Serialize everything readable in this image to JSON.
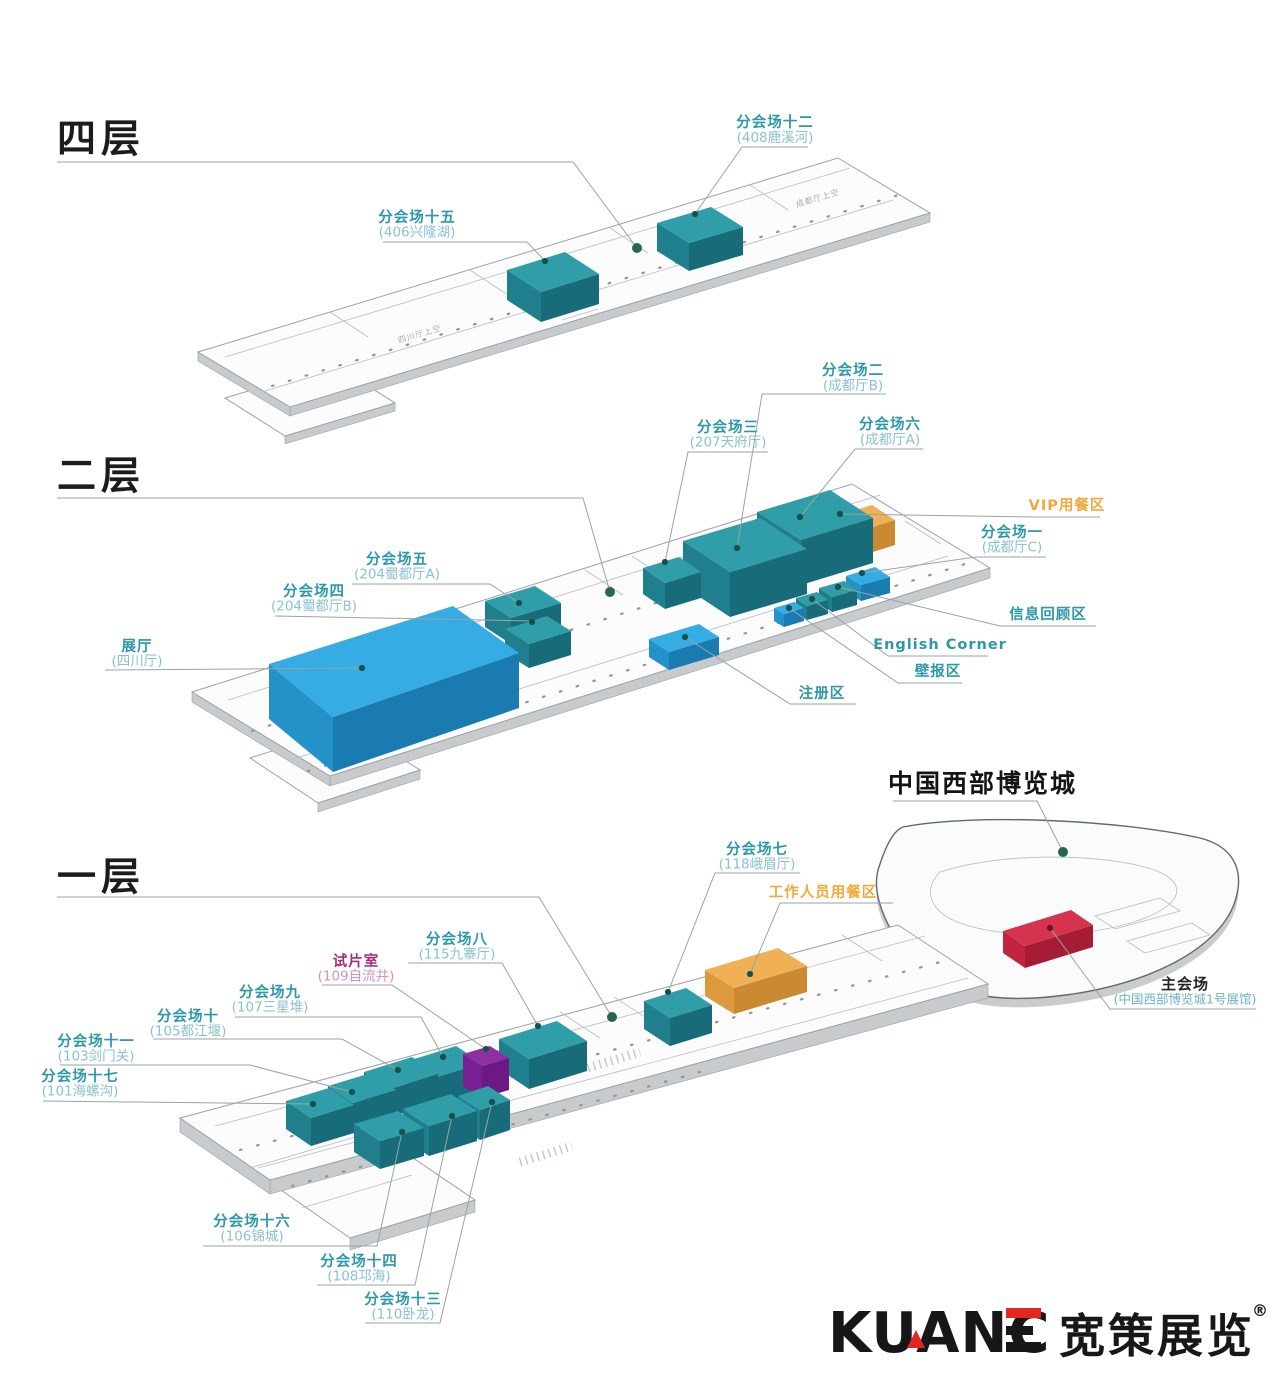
{
  "meta": {
    "venue_overview_heading": "中国西部博览城"
  },
  "colors": {
    "css": {
      "teal": "#2d98a8",
      "tealSub": "#8ac2cd",
      "orange": "#f2a93b",
      "magenta": "#a12e7d",
      "magentaSub": "#d193bd",
      "brandRed": "#e5261f"
    },
    "box": {
      "hall": {
        "t": "#2f9ea8",
        "l": "#207f8d",
        "f": "#186c79"
      },
      "func": {
        "t": "#35ace4",
        "l": "#2491c9",
        "f": "#1a7bb0"
      },
      "vip": {
        "t": "#f0b055",
        "l": "#dd9a3d",
        "f": "#cb8a32"
      },
      "screen": {
        "t": "#8e2fa2",
        "l": "#7a1f93",
        "f": "#6a1a82"
      },
      "main": {
        "t": "#d6344e",
        "l": "#c0243e",
        "f": "#a51c34"
      }
    }
  },
  "logo": {
    "latin": "KUANC",
    "cn": "宽策展览",
    "reg": "®"
  },
  "labels": [
    {
      "id": "floor4-heading",
      "s": "heading",
      "a": "start",
      "x": 57,
      "y": 152,
      "lines": [
        "四层"
      ],
      "leader": "M57,162 L573,162 L637,248",
      "dot": [
        637,
        248
      ],
      "dc": "green",
      "dr": 5
    },
    {
      "id": "floor2-heading",
      "s": "heading",
      "a": "start",
      "x": 57,
      "y": 489,
      "lines": [
        "二层"
      ],
      "leader": "M57,498 L583,498 L610,592",
      "dot": [
        610,
        592
      ],
      "dc": "green",
      "dr": 5
    },
    {
      "id": "floor1-heading",
      "s": "heading",
      "a": "start",
      "x": 57,
      "y": 890,
      "lines": [
        "一层"
      ],
      "leader": "M57,897 L539,897 L612,1017",
      "dot": [
        612,
        1017
      ],
      "dc": "green",
      "dr": 5
    },
    {
      "id": "expo-city-heading",
      "s": "city",
      "a": "start",
      "x": 888,
      "y": 792,
      "lines": [
        "中国西部博览城"
      ],
      "leader": "M893,801 L1037,801 L1063,852",
      "dot": [
        1063,
        852
      ],
      "dc": "green",
      "dr": 5
    },
    {
      "id": "venue-15",
      "s": "teal",
      "x": 417,
      "y": 222,
      "lh": 14.5,
      "lines": [
        "分会场十五",
        "(406兴隆湖)"
      ],
      "leader": "M383,242 L527,242 L545,261",
      "dot": [
        545,
        261
      ]
    },
    {
      "id": "venue-12",
      "s": "teal",
      "x": 775,
      "y": 127,
      "lh": 15,
      "lines": [
        "分会场十二",
        "(408鹿溪河)"
      ],
      "leader": "M808,147 L742,147 L695,214",
      "dot": [
        695,
        214
      ]
    },
    {
      "id": "venue-3",
      "s": "teal",
      "x": 728,
      "y": 432,
      "lh": 14.5,
      "lines": [
        "分会场三",
        "(207天府厅)"
      ],
      "leader": "M768,452 L688,452 L665,562",
      "dot": [
        665,
        562
      ]
    },
    {
      "id": "venue-2",
      "s": "teal",
      "x": 853,
      "y": 375,
      "lh": 15,
      "lines": [
        "分会场二",
        "(成都厅B)"
      ],
      "leader": "M886,394 L762,394 L737,548",
      "dot": [
        737,
        548
      ]
    },
    {
      "id": "venue-6",
      "s": "teal",
      "x": 890,
      "y": 429,
      "lh": 15,
      "lines": [
        "分会场六",
        "(成都厅A)"
      ],
      "leader": "M923,449 L855,449 L800,517",
      "dot": [
        800,
        517
      ]
    },
    {
      "id": "vip-dining",
      "s": "orange",
      "x": 1067,
      "y": 510,
      "lines": [
        "VIP用餐区"
      ],
      "leader": "M1100,517 L1032,517 L840,514",
      "dot": [
        840,
        514
      ]
    },
    {
      "id": "venue-1",
      "s": "teal",
      "x": 1012,
      "y": 537,
      "lh": 14.5,
      "lines": [
        "分会场一",
        "(成都厅C)"
      ],
      "leader": "M1046,557 L976,557 L862,573",
      "dot": [
        862,
        573
      ]
    },
    {
      "id": "info-review-area",
      "s": "teal",
      "x": 1048,
      "y": 619,
      "lines": [
        "信息回顾区"
      ],
      "leader": "M1096,626 L1000,626 L838,587",
      "dot": [
        838,
        587
      ]
    },
    {
      "id": "english-corner",
      "s": "teal",
      "x": 940,
      "y": 649,
      "lines": [
        "English Corner"
      ],
      "leader": "M988,656 L888,656 L812,599",
      "dot": [
        812,
        599
      ]
    },
    {
      "id": "poster-area",
      "s": "teal",
      "x": 938,
      "y": 676,
      "lines": [
        "壁报区"
      ],
      "leader": "M962,683 L898,683 L789,608",
      "dot": [
        789,
        608
      ]
    },
    {
      "id": "registration-area",
      "s": "teal",
      "x": 822,
      "y": 698,
      "lines": [
        "注册区"
      ],
      "leader": "M856,704 L790,704 L685,637",
      "dot": [
        685,
        637
      ]
    },
    {
      "id": "venue-5",
      "s": "teal",
      "x": 397,
      "y": 564,
      "lh": 14.5,
      "lines": [
        "分会场五",
        "(204蜀都厅A)"
      ],
      "leader": "M352,584 L490,584 L519,603",
      "dot": [
        519,
        603
      ]
    },
    {
      "id": "venue-4",
      "s": "teal",
      "x": 314,
      "y": 596,
      "lh": 14.5,
      "lines": [
        "分会场四",
        "(204蜀都厅B)"
      ],
      "leader": "M275,616 L532,621",
      "dot": [
        532,
        622
      ]
    },
    {
      "id": "exhibition-hall",
      "s": "teal",
      "x": 137,
      "y": 651,
      "lh": 14.5,
      "lines": [
        "展厅",
        "(四川厅)"
      ],
      "leader": "M105,670 L362,668",
      "dot": [
        362,
        668
      ]
    },
    {
      "id": "venue-7",
      "s": "teal",
      "x": 757,
      "y": 854,
      "lh": 14.5,
      "lines": [
        "分会场七",
        "(118峨眉厅)"
      ],
      "leader": "M800,873 L715,873 L668,992",
      "dot": [
        668,
        992
      ]
    },
    {
      "id": "staff-dining",
      "s": "orange",
      "x": 823,
      "y": 897,
      "lines": [
        "工作人员用餐区"
      ],
      "leader": "M893,903 L780,903 L750,974",
      "dot": [
        750,
        974
      ]
    },
    {
      "id": "venue-8",
      "s": "teal",
      "x": 457,
      "y": 944,
      "lh": 14.5,
      "lines": [
        "分会场八",
        "(115九寨厅)"
      ],
      "leader": "M408,963 L502,963 L538,1026",
      "dot": [
        538,
        1026
      ]
    },
    {
      "id": "screening-room",
      "s": "magenta",
      "x": 356,
      "y": 966,
      "lh": 14.5,
      "lines": [
        "试片室",
        "(109自流井)"
      ],
      "leader": "M322,985 L392,985 L486,1049",
      "dot": [
        486,
        1049
      ]
    },
    {
      "id": "venue-9",
      "s": "teal",
      "x": 270,
      "y": 997,
      "lh": 14.5,
      "lines": [
        "分会场九",
        "(107三星堆)"
      ],
      "leader": "M235,1017 L421,1017 L443,1057",
      "dot": [
        443,
        1057
      ]
    },
    {
      "id": "venue-10",
      "s": "teal",
      "x": 188,
      "y": 1021,
      "lh": 14.5,
      "lines": [
        "分会场十",
        "(105都江堰)"
      ],
      "leader": "M153,1039 L342,1039 L398,1070",
      "dot": [
        398,
        1070
      ]
    },
    {
      "id": "venue-11",
      "s": "teal",
      "x": 96,
      "y": 1046,
      "lh": 14.5,
      "lines": [
        "分会场十一",
        "(103剑门关)"
      ],
      "leader": "M60,1065 L250,1065 L352,1092",
      "dot": [
        352,
        1092
      ]
    },
    {
      "id": "venue-17",
      "s": "teal",
      "x": 80,
      "y": 1081,
      "lh": 14.5,
      "lines": [
        "分会场十七",
        "(101海螺沟)"
      ],
      "leader": "M43,1101 L313,1104",
      "dot": [
        313,
        1104
      ]
    },
    {
      "id": "venue-16",
      "s": "teal",
      "x": 252,
      "y": 1226,
      "lh": 14.5,
      "lines": [
        "分会场十六",
        "(106锦城)"
      ],
      "leader": "M203,1246 L377,1246 L402,1132",
      "dot": [
        402,
        1132
      ]
    },
    {
      "id": "venue-14",
      "s": "teal",
      "x": 359,
      "y": 1266,
      "lh": 14.5,
      "lines": [
        "分会场十四",
        "(108邛海)"
      ],
      "leader": "M317,1285 L415,1285 L452,1116",
      "dot": [
        452,
        1116
      ]
    },
    {
      "id": "venue-13",
      "s": "teal",
      "x": 403,
      "y": 1304,
      "lh": 14.5,
      "lines": [
        "分会场十三",
        "(110卧龙)"
      ],
      "leader": "M365,1323 L440,1323 L492,1102",
      "dot": [
        492,
        1102
      ]
    },
    {
      "id": "main-venue",
      "s": "main",
      "x": 1185,
      "y": 989,
      "lh": 14.5,
      "lines": [
        "主会场",
        "(中国西部博览城1号展馆)"
      ],
      "leader": "M1256,1009 L1110,1009 L1050,928",
      "dot": [
        1050,
        928
      ],
      "dc": "red"
    }
  ],
  "boxes": [
    {
      "id": "venue-12",
      "c": "hall",
      "top": "657,223 711,207 743,227 689,243",
      "left": "657,223 689,243 689,271 657,251",
      "front": "689,243 743,227 743,255 689,271"
    },
    {
      "id": "venue-15",
      "c": "hall",
      "top": "507,270 565,252 599,274 541,292",
      "left": "507,270 541,292 541,322 507,300",
      "front": "541,292 599,274 599,304 541,322"
    },
    {
      "id": "vip-dining",
      "c": "vip",
      "top": "805,526 872,505 895,520 828,541",
      "left": "805,526 828,541 828,566 805,551",
      "front": "828,541 895,520 895,545 828,566"
    },
    {
      "id": "venue-6",
      "c": "hall",
      "top": "757,512 830,490 873,518 801,540",
      "left": "757,512 801,540 801,585 757,557",
      "front": "801,540 873,518 873,563 801,585"
    },
    {
      "id": "venue-2",
      "c": "hall",
      "top": "683,541 760,518 807,549 730,572",
      "left": "683,541 730,572 730,617 683,586",
      "front": "730,572 807,549 807,594 730,617"
    },
    {
      "id": "venue-3",
      "c": "hall",
      "top": "643,568 679,557 701,572 665,583",
      "left": "643,568 665,583 665,609 643,594",
      "front": "665,583 701,572 701,598 665,609"
    },
    {
      "id": "venue-1-box",
      "c": "func",
      "top": "846,576 875,567 890,577 861,585",
      "left": "846,576 861,585 861,601 846,592",
      "front": "861,585 890,577 890,593 861,601"
    },
    {
      "id": "info-review-box",
      "c": "hall",
      "top": "819,588 844,581 857,590 832,597",
      "left": "819,588 832,597 832,612 819,603",
      "front": "832,597 857,590 857,605 832,612"
    },
    {
      "id": "english-corner-box",
      "c": "hall",
      "top": "796,598 817,592 828,600 807,606",
      "left": "796,598 807,606 807,620 796,612",
      "front": "807,606 828,600 828,614 807,620"
    },
    {
      "id": "poster-box",
      "c": "func",
      "top": "774,608 794,602 804,608 784,614",
      "left": "774,608 784,614 784,627 774,621",
      "front": "784,614 804,608 804,621 784,627"
    },
    {
      "id": "venue-5",
      "c": "hall",
      "top": "485,601 535,586 561,603 511,618",
      "left": "485,601 511,618 511,644 485,627",
      "front": "511,618 561,603 561,629 511,644"
    },
    {
      "id": "venue-4",
      "c": "hall",
      "top": "505,629 547,616 571,631 529,644",
      "left": "505,629 529,644 529,668 505,653",
      "front": "529,644 571,631 571,655 529,668"
    },
    {
      "id": "exhibition-hall",
      "c": "func",
      "top": "269,664 453,606 519,653 333,717",
      "left": "269,664 333,717 333,772 269,719",
      "front": "333,717 519,653 519,708 333,772"
    },
    {
      "id": "registration-box",
      "c": "func",
      "top": "649,639 699,624 719,637 669,652",
      "left": "649,639 669,652 669,670 649,657",
      "front": "669,652 719,637 719,655 669,670"
    },
    {
      "id": "staff-dining",
      "c": "vip",
      "top": "705,970 778,948 807,966 734,988",
      "left": "705,970 734,988 734,1014 705,996",
      "front": "734,988 807,966 807,992 734,1014"
    },
    {
      "id": "venue-7",
      "c": "hall",
      "top": "644,1001 686,988 712,1005 670,1018",
      "left": "644,1001 670,1018 670,1046 644,1029",
      "front": "670,1018 712,1005 712,1033 670,1046"
    },
    {
      "id": "venue-8",
      "c": "hall",
      "top": "499,1039 557,1021 587,1041 529,1059",
      "left": "499,1039 529,1059 529,1089 499,1069",
      "front": "529,1059 587,1041 587,1071 529,1089"
    },
    {
      "id": "venue-9",
      "c": "hall",
      "top": "408,1061 456,1046 482,1063 434,1078",
      "left": "408,1061 434,1078 434,1106 408,1089",
      "front": "434,1078 482,1063 482,1091 434,1106"
    },
    {
      "id": "screening-room",
      "c": "screen",
      "top": "463,1054 490,1046 509,1058 482,1066",
      "left": "463,1054 482,1066 482,1098 463,1086",
      "front": "482,1066 509,1058 509,1090 482,1098"
    },
    {
      "id": "venue-10",
      "c": "hall",
      "top": "364,1072 412,1057 438,1074 390,1089",
      "left": "364,1072 390,1089 390,1117 364,1100",
      "front": "390,1089 438,1074 438,1102 390,1117"
    },
    {
      "id": "venue-11",
      "c": "hall",
      "top": "328,1086 371,1073 396,1090 353,1103",
      "left": "328,1086 353,1103 353,1131 328,1114",
      "front": "353,1103 396,1090 396,1118 353,1131"
    },
    {
      "id": "venue-17",
      "c": "hall",
      "top": "286,1101 329,1088 354,1105 311,1118",
      "left": "286,1101 311,1118 311,1146 286,1129",
      "front": "311,1118 354,1105 354,1133 311,1146"
    },
    {
      "id": "venue-13",
      "c": "hall",
      "top": "458,1096 488,1086 510,1100 480,1110",
      "left": "458,1096 480,1110 480,1140 458,1126",
      "front": "480,1110 510,1100 510,1130 480,1140"
    },
    {
      "id": "venue-14",
      "c": "hall",
      "top": "403,1109 451,1094 477,1111 429,1126",
      "left": "403,1109 429,1126 429,1156 403,1139",
      "front": "429,1126 477,1111 477,1141 429,1156"
    },
    {
      "id": "venue-16",
      "c": "hall",
      "top": "354,1124 398,1111 424,1128 380,1141",
      "left": "354,1124 380,1141 380,1169 354,1152",
      "front": "380,1141 424,1128 424,1156 380,1169"
    },
    {
      "id": "main-venue",
      "c": "main",
      "top": "1003,931 1071,910 1093,925 1025,946",
      "left": "1003,931 1025,946 1025,968 1003,953",
      "front": "1025,946 1093,925 1093,947 1025,968"
    }
  ],
  "plan": [
    {
      "d": "M225,357 L850,168",
      "t": "s"
    },
    {
      "d": "M262,392 L893,200",
      "t": "s"
    },
    {
      "d": "M330,312 L368,337",
      "t": "s"
    },
    {
      "d": "M470,270 L508,295",
      "t": "s"
    },
    {
      "d": "M610,228 L648,253",
      "t": "s"
    },
    {
      "d": "M750,185 L788,210",
      "t": "s"
    },
    {
      "d": "M272,386 L905,193",
      "t": "d"
    },
    {
      "d": "M552,298 L588,287",
      "t": "s"
    },
    {
      "d": "M557,309 L593,298",
      "t": "s"
    },
    {
      "d": "M562,320 L598,309",
      "t": "s"
    },
    {
      "d": "M228,700 L880,495",
      "t": "s"
    },
    {
      "d": "M290,760 L948,556",
      "t": "s"
    },
    {
      "d": "M252,731 L905,524",
      "t": "d"
    },
    {
      "d": "M308,771 L965,564",
      "t": "d"
    },
    {
      "d": "M585,570 L623,595",
      "t": "s"
    },
    {
      "d": "M632,556 L670,581",
      "t": "s"
    },
    {
      "d": "M905,521 L941,544",
      "t": "s"
    },
    {
      "d": "M618,690 L672,673",
      "t": "h"
    },
    {
      "d": "M700,664 L754,647",
      "t": "h"
    },
    {
      "d": "M215,1126 L925,936",
      "t": "s"
    },
    {
      "d": "M258,1168 L968,978",
      "t": "s"
    },
    {
      "d": "M240,1150 L948,960",
      "t": "d"
    },
    {
      "d": "M292,1186 L700,1072",
      "t": "d"
    },
    {
      "d": "M560,1012 L600,1038",
      "t": "s"
    },
    {
      "d": "M614,997 L654,1023",
      "t": "s"
    },
    {
      "d": "M762,957 L802,983",
      "t": "s"
    },
    {
      "d": "M842,935 L882,961",
      "t": "s"
    },
    {
      "d": "M588,1068 L640,1052",
      "t": "h"
    },
    {
      "d": "M520,1162 L572,1146",
      "t": "h"
    },
    {
      "d": "M250,1168 L362,1135",
      "t": "s"
    },
    {
      "d": "M302,1208 L412,1175",
      "t": "s"
    },
    {
      "d": "M940,872 C1000,853 1090,853 1145,867 C1185,878 1188,899 1150,916 C1100,938 1010,941 960,923 C930,912 922,890 940,872",
      "t": "s"
    },
    {
      "d": "M1095,916 L1160,898 L1180,911 L1115,929 Z",
      "t": "s"
    },
    {
      "d": "M1127,941 L1192,923 L1210,935 L1145,953 Z",
      "t": "s"
    }
  ],
  "planTexts": [
    {
      "t": "成都厅上空",
      "x": 797,
      "y": 207,
      "r": -16.5
    },
    {
      "t": "四川厅上空",
      "x": 399,
      "y": 343,
      "r": -16.5
    }
  ]
}
